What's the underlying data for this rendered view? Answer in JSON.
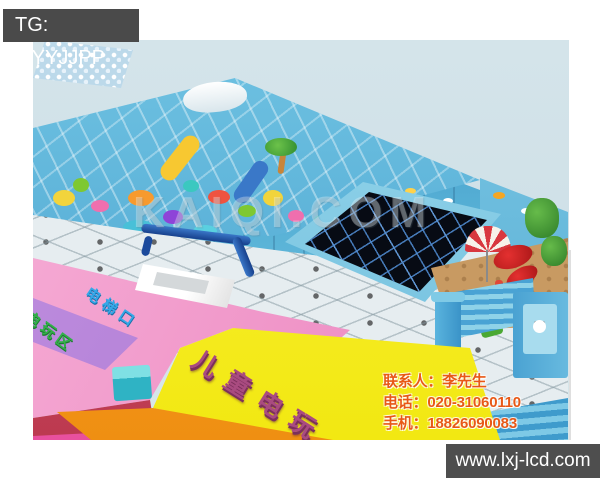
{
  "overlay": {
    "tg_label": "TG: MYYJJPP",
    "website": "www.lxj-lcd.com",
    "watermark": "KAIQI.COM"
  },
  "contact": {
    "lines": [
      "联系人：李先生",
      "电话：020-31060110",
      "手机：18826090083"
    ]
  },
  "floor_labels": {
    "arcade_large": "儿童电玩",
    "elevator": "电梯口",
    "arcade_small": "电玩区"
  },
  "scene": {
    "subject": "indoor children's playground 3D floor-plan render",
    "colors": {
      "photo_background": "#cfe0e7",
      "bar_background": "#4a4a4a",
      "contact_text": "#e85816",
      "pink_floor": "#ef93c7",
      "purple_walkway": "#a874cf",
      "yellow_floor": "#f2e812",
      "orange_strip": "#f39422",
      "crimson_edge": "#cc4156",
      "structure_blue": "#4aa3cf",
      "trampoline_black": "#070b14",
      "sand": "#c89a62"
    }
  }
}
